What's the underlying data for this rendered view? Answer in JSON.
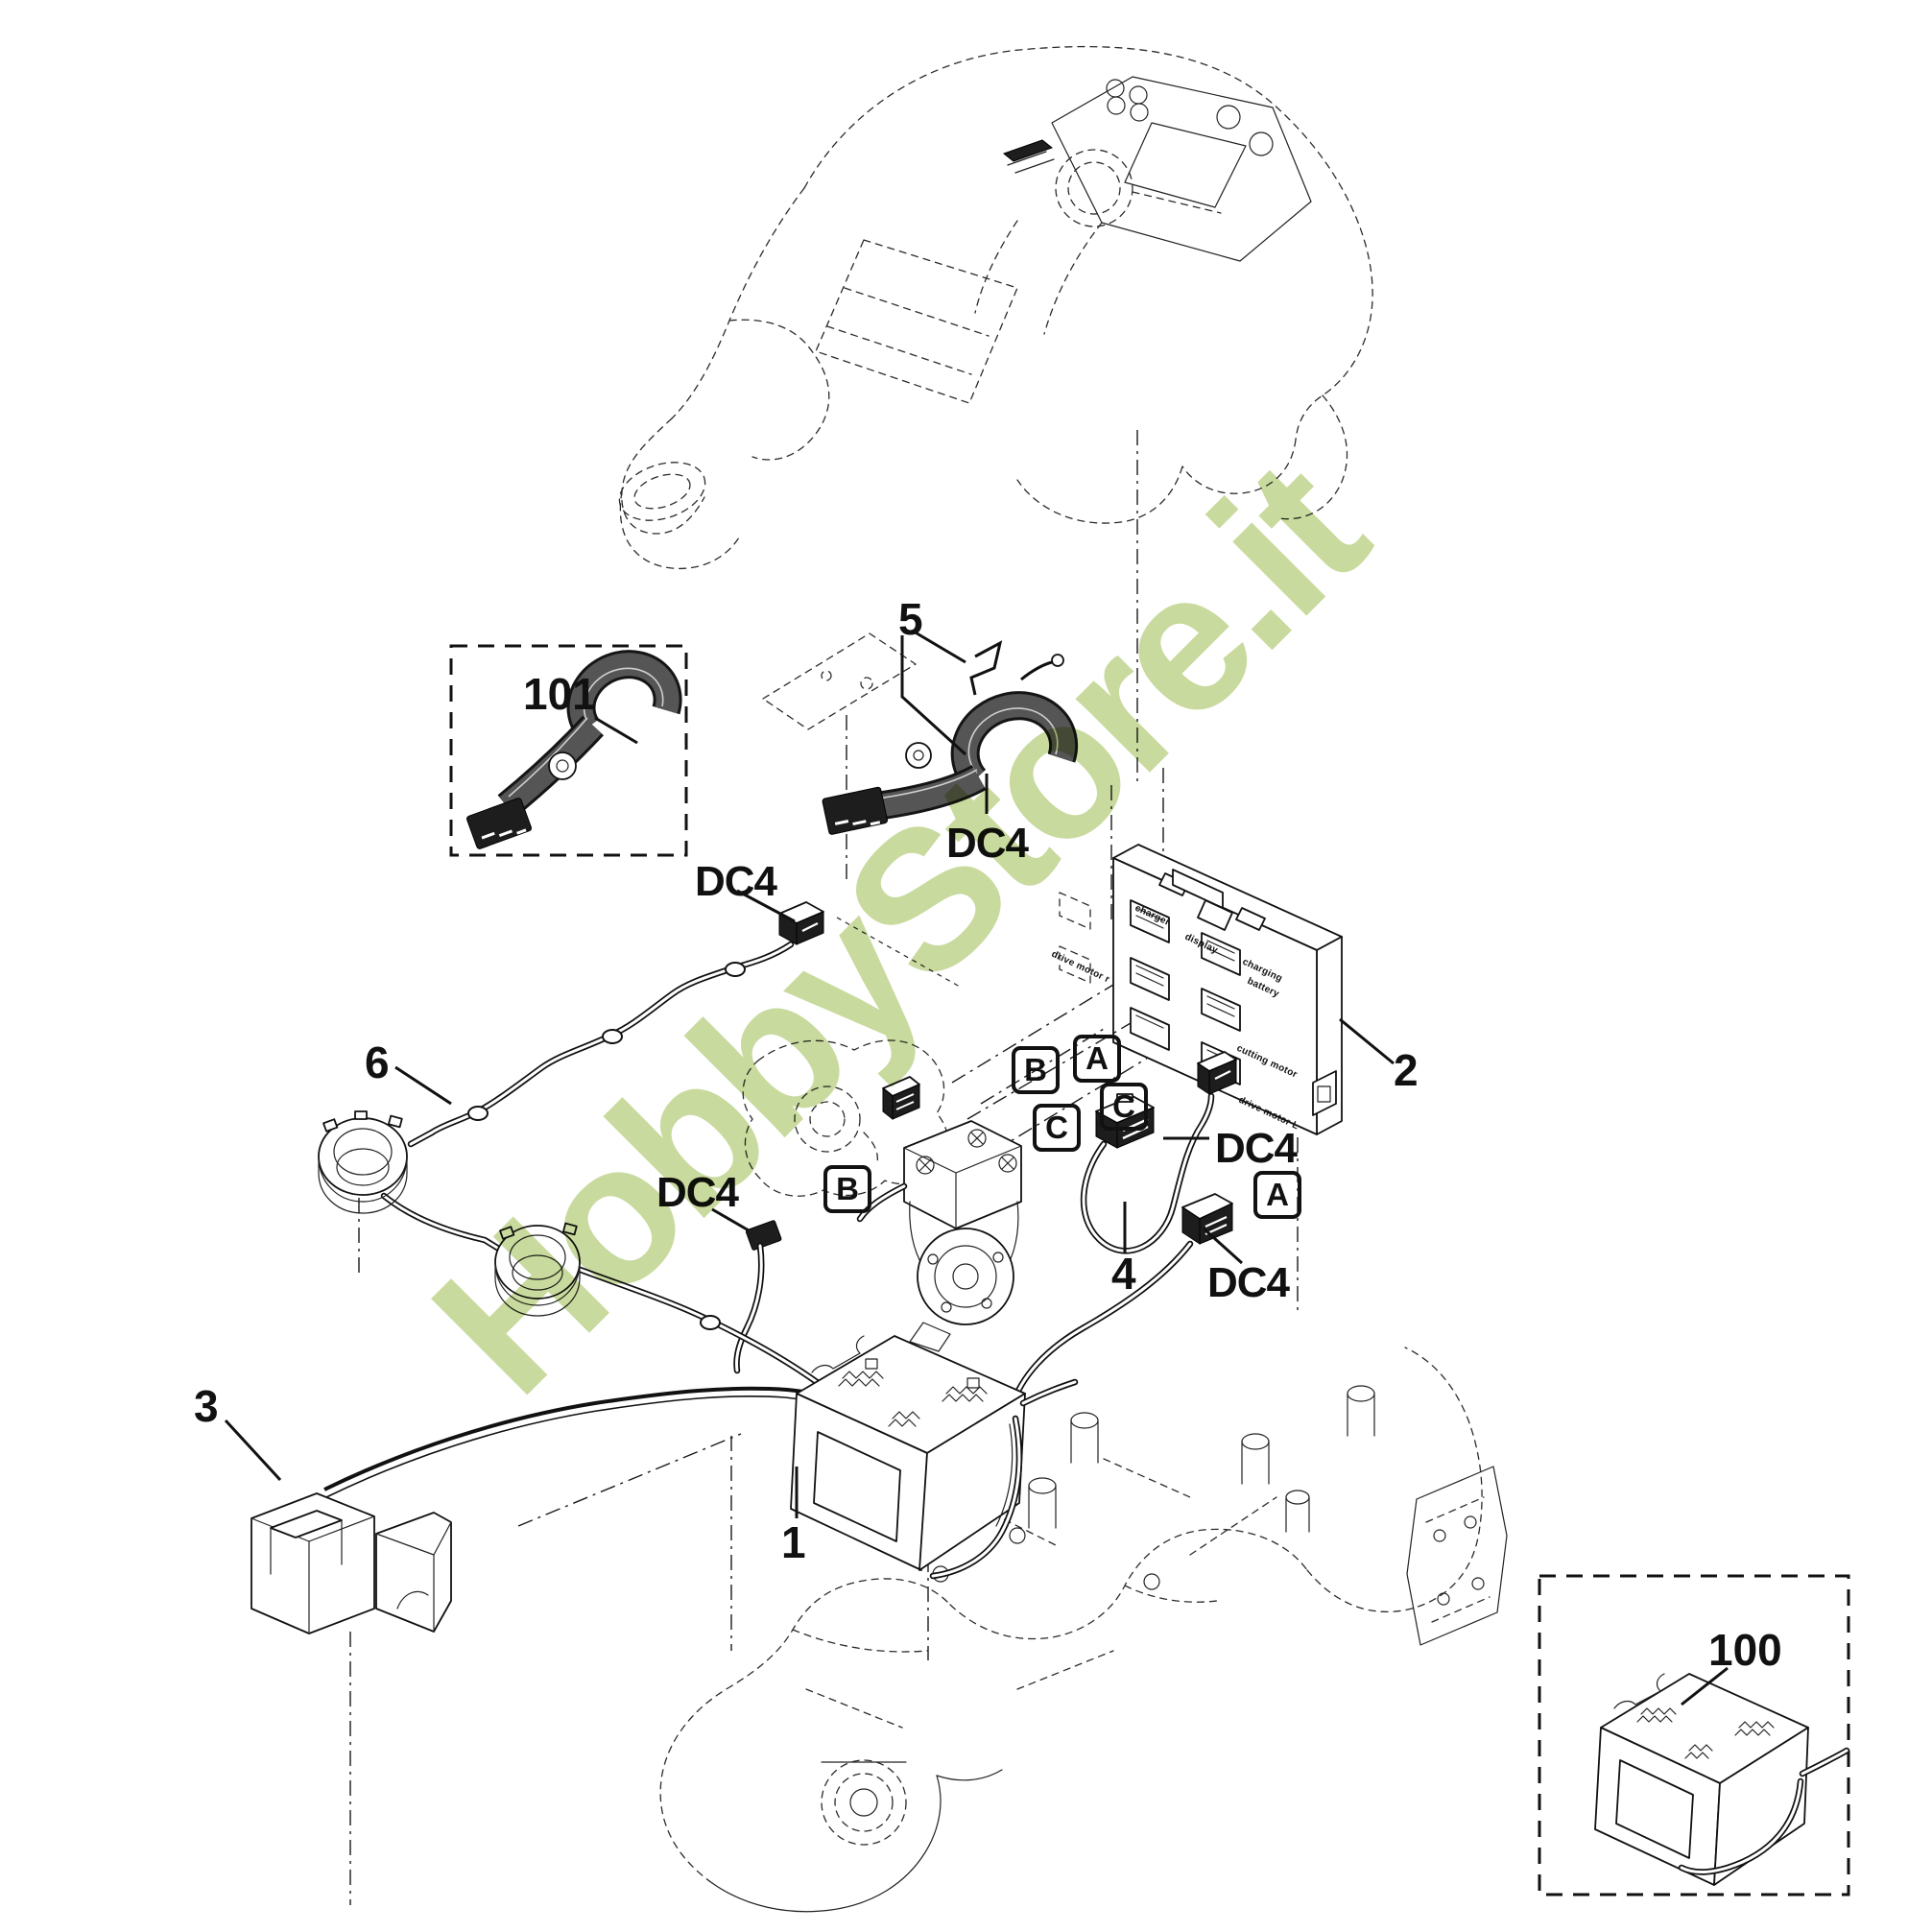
{
  "watermark": {
    "text": "HobbyStore.it",
    "color": "#c9da9e"
  },
  "callouts": {
    "part_101": "101",
    "part_100": "100",
    "part_1": "1",
    "part_2": "2",
    "part_3": "3",
    "part_4": "4",
    "part_5": "5",
    "part_6": "6",
    "connector_dc4": "DC4",
    "slot_a": "A",
    "slot_b": "B",
    "slot_c": "C"
  },
  "board_labels": {
    "charger": "charger",
    "display": "display",
    "drive_motor_r": "drive motor r",
    "charging": "charging",
    "battery": "battery",
    "cutting_motor": "cutting motor",
    "drive_motor_l": "drive motor L"
  }
}
